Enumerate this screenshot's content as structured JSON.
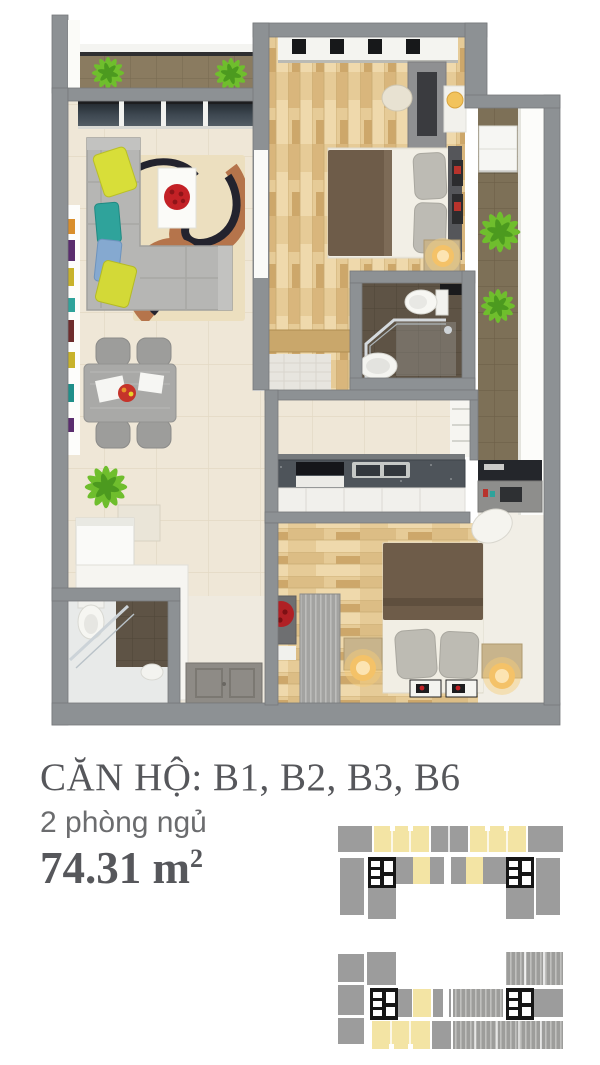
{
  "header": {
    "title": "CĂN HỘ: B1, B2, B3, B6",
    "subtitle": "2 phòng ngủ",
    "area_value": "74.31 m",
    "area_superscript": "2"
  },
  "floor_plan": {
    "kind": "3d-top-down-apartment-render",
    "rooms": [
      "balcony",
      "living-room",
      "dining-area",
      "bedroom-1",
      "bathroom-1",
      "kitchen",
      "hallway",
      "bedroom-2",
      "bathroom-2",
      "entry",
      "side-corridor"
    ]
  },
  "key_plans": {
    "plans": [
      "upper-block-level-key-plan",
      "lower-block-level-key-plan"
    ],
    "highlighted_units_color": "#f3e4a4",
    "unit_color": "#9c9c9c"
  },
  "colors": {
    "wall": "#8d9194",
    "textDark": "#56575b",
    "textGrey": "#6b6c6e",
    "floorCream": "#efe7d7",
    "wood": "#e6cb97",
    "corridorTile": "#7d7057",
    "balconyTile": "#8a7b60",
    "bathTile": "#5e5345",
    "glass": "#39424a",
    "sofaGrey": "#b6b6b4",
    "rugBase": "#ecdfbf",
    "rugBrown": "#b5744b",
    "rugNavy": "#23232e",
    "pillowYellow": "#d8de39",
    "pillowTeal": "#2fa39b",
    "pillowBlue": "#85a9d0",
    "accentRed": "#c32126",
    "counterDark": "#4e545a",
    "bedBrown": "#6e5c49",
    "linenWhite": "#f1eee4",
    "lampGlow": "#f4c268",
    "furnWood": "#c8b48c",
    "plant": "#6fbe2d",
    "plantDark": "#4c9a1f",
    "keyGrey": "#9c9c9c",
    "keyYellow": "#f3e4a4",
    "coreBlack": "#161616"
  }
}
